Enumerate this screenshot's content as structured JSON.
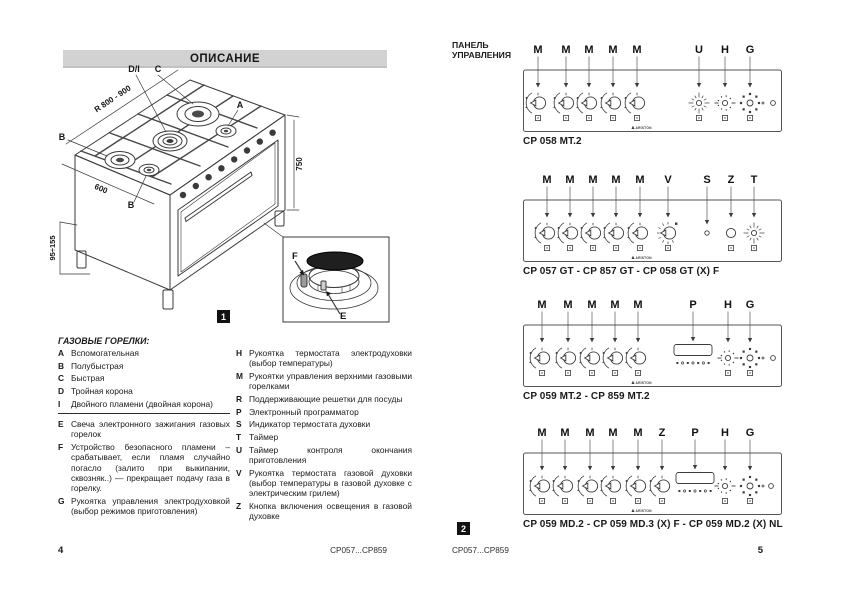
{
  "left_page": {
    "title": "ОПИСАНИЕ",
    "figure_badge": "1",
    "diagram": {
      "labels": {
        "di": "D/I",
        "c": "C",
        "a": "A",
        "b": "B",
        "b2": "B"
      },
      "dims": {
        "radius": "R 800 - 900",
        "width": "600",
        "height": "750",
        "legs": "95÷155"
      },
      "inset": {
        "f": "F",
        "e": "E"
      }
    },
    "legend": {
      "title": "ГАЗОВЫЕ ГОРЕЛКИ:",
      "left_groups": [
        [
          {
            "key": "A",
            "text": "Вспомогательная"
          },
          {
            "key": "B",
            "text": "Полубыстрая"
          },
          {
            "key": "C",
            "text": "Быстрая"
          },
          {
            "key": "D",
            "text": "Тройная корона"
          },
          {
            "key": "I",
            "text": "Двойного пламени (двойная корона)"
          }
        ],
        [
          {
            "key": "E",
            "text": "Свеча электронного зажигания газовых горелок"
          },
          {
            "key": "F",
            "text": "Устройство безопасного пламени – срабатывает, если пламя случайно погасло (залито при выкипании, сквозняк..) — прекращает подачу газа в горелку."
          },
          {
            "key": "G",
            "text": "Рукоятка управления электродуховкой (выбор режимов приготовления)"
          }
        ]
      ],
      "right_items": [
        {
          "key": "H",
          "text": "Рукоятка термостата электродуховки (выбор температуры)"
        },
        {
          "key": "M",
          "text": "Рукоятки управления верхними газовыми горелками"
        },
        {
          "key": "R",
          "text": "Поддерживающие решетки для посуды"
        },
        {
          "key": "P",
          "text": "Электронный программатор"
        },
        {
          "key": "S",
          "text": "Индикатор термостата духовки"
        },
        {
          "key": "T",
          "text": "Таймер"
        },
        {
          "key": "U",
          "text": "Таймер контроля окончания приготовления"
        },
        {
          "key": "V",
          "text": "Рукоятка термостата газовой духовки (выбор температуры в газовой духовке с электрическим грилем)"
        },
        {
          "key": "Z",
          "text": "Кнопка включения освещения в газовой духовке"
        }
      ]
    },
    "footer": {
      "page_number": "4",
      "model_range": "CP057...CP859"
    }
  },
  "right_page": {
    "title_line1": "ПАНЕЛЬ",
    "title_line2": "УПРАВЛЕНИЯ",
    "figure_badge": "2",
    "brand": "ARISTON",
    "panels": [
      {
        "caption": "CP 058 MT.2",
        "controls": [
          {
            "label": "M",
            "type": "gas",
            "x": 15
          },
          {
            "label": "M",
            "type": "gas",
            "x": 43
          },
          {
            "label": "M",
            "type": "gas",
            "x": 66
          },
          {
            "label": "M",
            "type": "gas",
            "x": 90
          },
          {
            "label": "M",
            "type": "gas",
            "x": 114
          },
          {
            "label": "U",
            "type": "timer",
            "x": 176
          },
          {
            "label": "H",
            "type": "thermo",
            "x": 202
          },
          {
            "label": "G",
            "type": "selector",
            "x": 227
          },
          {
            "type": "indicator",
            "x": 250
          }
        ]
      },
      {
        "caption": "CP 057 GT - CP 857 GT - CP 058 GT (X) F",
        "controls": [
          {
            "label": "M",
            "type": "gas",
            "x": 24
          },
          {
            "label": "M",
            "type": "gas",
            "x": 47
          },
          {
            "label": "M",
            "type": "gas",
            "x": 70
          },
          {
            "label": "M",
            "type": "gas",
            "x": 93
          },
          {
            "label": "M",
            "type": "gas",
            "x": 117
          },
          {
            "label": "V",
            "type": "vknob",
            "x": 145
          },
          {
            "label": "S",
            "type": "sled",
            "x": 184
          },
          {
            "label": "Z",
            "type": "button",
            "x": 208
          },
          {
            "label": "T",
            "type": "timer",
            "x": 231
          }
        ]
      },
      {
        "caption": "CP 059 MT.2 - CP 859 MT.2",
        "controls": [
          {
            "label": "M",
            "type": "gas",
            "x": 19
          },
          {
            "label": "M",
            "type": "gas",
            "x": 45
          },
          {
            "label": "M",
            "type": "gas",
            "x": 69
          },
          {
            "label": "M",
            "type": "gas",
            "x": 92
          },
          {
            "label": "M",
            "type": "gas",
            "x": 115
          },
          {
            "label": "P",
            "type": "prog",
            "x": 170
          },
          {
            "label": "H",
            "type": "thermo",
            "x": 205
          },
          {
            "label": "G",
            "type": "selector",
            "x": 227
          },
          {
            "type": "indicator",
            "x": 250
          }
        ]
      },
      {
        "caption": "CP 059 MD.2 - CP 059 MD.3 (X) F - CP 059 MD.2 (X) NL",
        "controls": [
          {
            "label": "M",
            "type": "gas",
            "x": 19
          },
          {
            "label": "M",
            "type": "gas",
            "x": 42
          },
          {
            "label": "M",
            "type": "gas",
            "x": 67
          },
          {
            "label": "M",
            "type": "gas",
            "x": 90
          },
          {
            "label": "M",
            "type": "gas",
            "x": 115
          },
          {
            "label": "Z",
            "type": "gas",
            "x": 139
          },
          {
            "label": "P",
            "type": "prog",
            "x": 172
          },
          {
            "label": "H",
            "type": "thermo",
            "x": 202
          },
          {
            "label": "G",
            "type": "selector",
            "x": 227
          },
          {
            "type": "indicator",
            "x": 248
          }
        ]
      }
    ],
    "footer": {
      "model_range": "CP057...CP859",
      "page_number": "5"
    }
  }
}
